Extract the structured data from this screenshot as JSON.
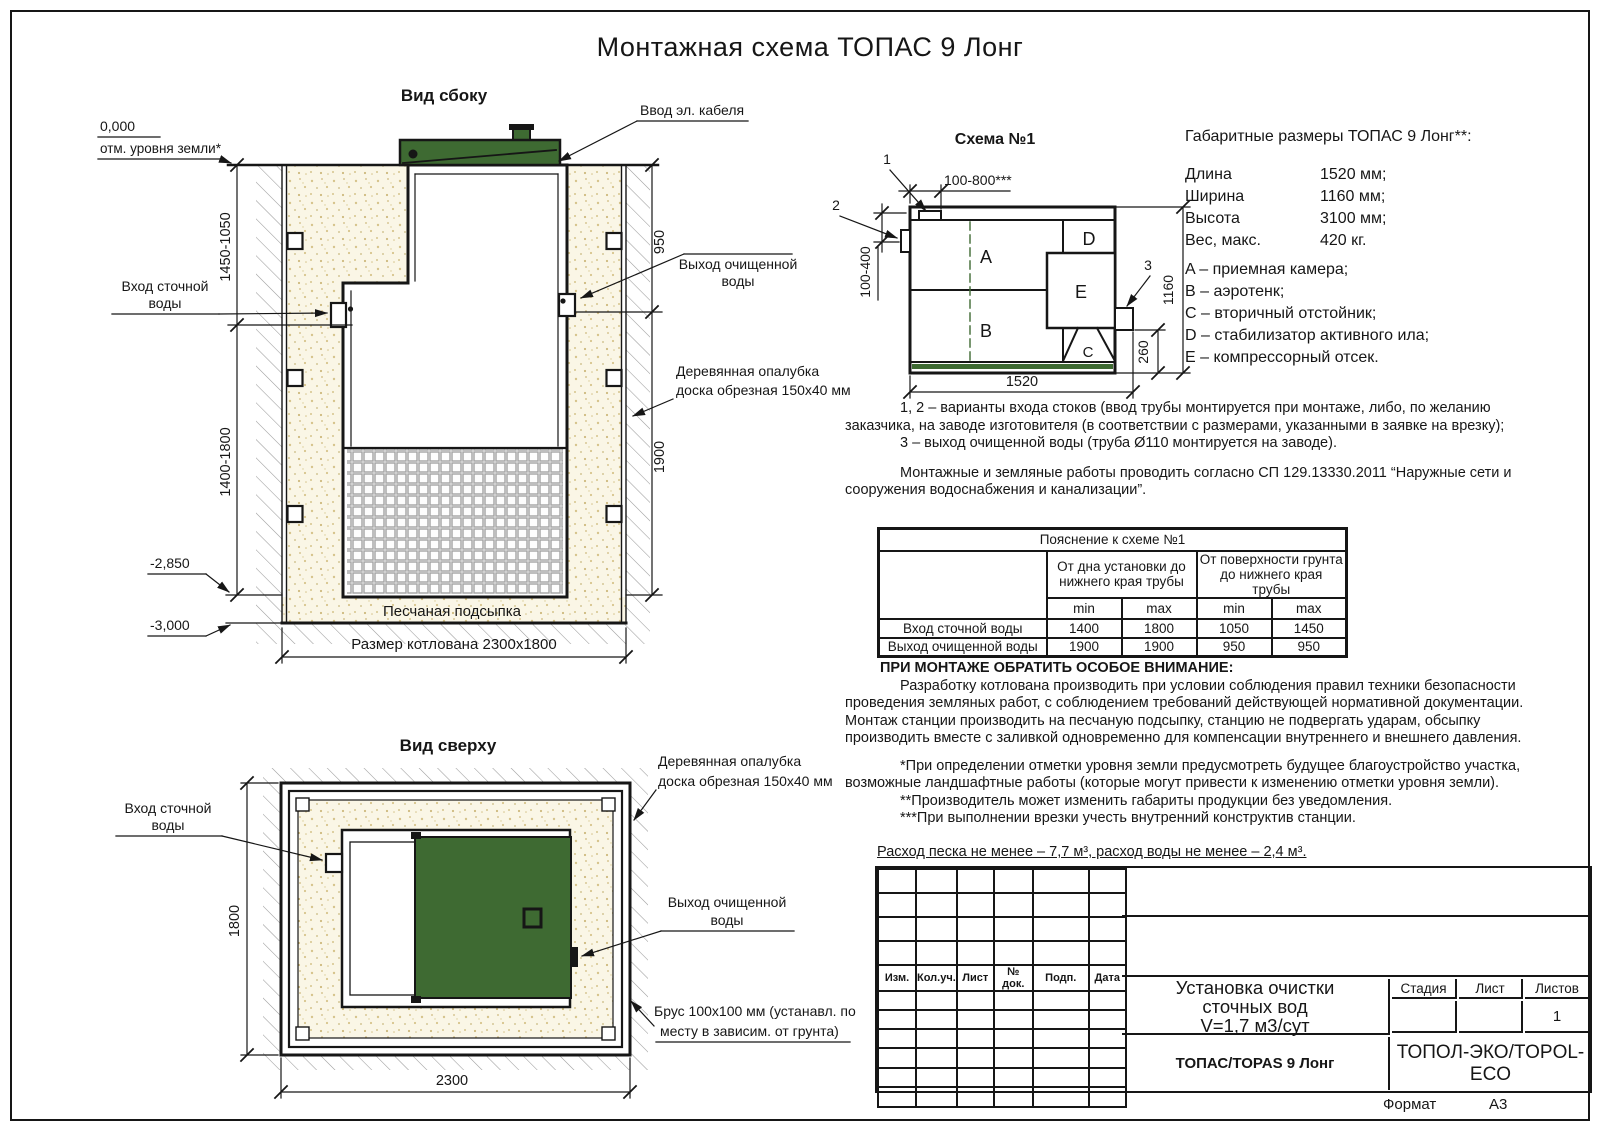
{
  "page": {
    "title": "Монтажная схема ТОПАС 9 Лонг",
    "format_label": "Формат",
    "format_value": "А3"
  },
  "colors": {
    "green": "#3E6A32",
    "line": "#161616",
    "sand_bg": "#faf6e6",
    "sand_dot": "#d6c48c",
    "hatch": "#9a9a9a",
    "grid": "#a3a3a3"
  },
  "side_view": {
    "title": "Вид сбоку",
    "labels": {
      "cable": "Ввод эл. кабеля",
      "zero_mark": "0,000",
      "ground_mark": "отм. уровня земли*",
      "inlet_1": "Вход сточной",
      "inlet_2": "воды",
      "outlet_1": "Выход очищенной",
      "outlet_2": "воды",
      "formwork_1": "Деревянная опалубка",
      "formwork_2": "доска обрезная 150х40 мм",
      "sand": "Песчаная подсыпка",
      "pit_size": "Размер котлована 2300х1800",
      "lvl_sand": "-2,850",
      "lvl_bottom": "-3,000"
    },
    "dims": {
      "left_top": "1450-1050",
      "left_bottom": "1400-1800",
      "right_top": "950",
      "right_bottom": "1900"
    }
  },
  "top_view": {
    "title": "Вид сверху",
    "labels": {
      "inlet_1": "Вход сточной",
      "inlet_2": "воды",
      "formwork_1": "Деревянная опалубка",
      "formwork_2": "доска обрезная 150х40 мм",
      "outlet_1": "Выход очищенной",
      "outlet_2": "воды",
      "beam_1": "Брус 100х100 мм (устанавл. по",
      "beam_2": "месту в зависим. от грунта)"
    },
    "dims": {
      "height": "1800",
      "width": "2300"
    }
  },
  "schema": {
    "title": "Схема №1",
    "callouts": [
      "1",
      "2",
      "3"
    ],
    "letters": [
      "A",
      "B",
      "C",
      "D",
      "E"
    ],
    "dims": {
      "top": "100-800***",
      "left": "100-400",
      "right": "1160",
      "outlet": "260",
      "bottom": "1520"
    }
  },
  "specs": {
    "title": "Габаритные размеры ТОПАС 9 Лонг**:",
    "rows": [
      {
        "label": "Длина",
        "value": "1520 мм;"
      },
      {
        "label": "Ширина",
        "value": "1160 мм;"
      },
      {
        "label": "Высота",
        "value": "3100 мм;"
      },
      {
        "label": "Вес, макс.",
        "value": "420 кг."
      }
    ],
    "legend": [
      "A – приемная камера;",
      "B – аэротенк;",
      "C – вторичный отстойник;",
      "D – стабилизатор активного ила;",
      "E – компрессорный отсек."
    ]
  },
  "notes": {
    "p1": "1, 2 – варианты входа  стоков (ввод трубы монтируется при монтаже, либо, по желанию заказчика, на заводе изготовителя (в соответствии с размерами, указанными в заявке на врезку);",
    "p2": "3 – выход очищенной воды (труба Ø110 монтируется на заводе).",
    "p3": "Монтажные и земляные работы проводить согласно СП 129.13330.2011 “Наружные сети и сооружения водоснабжения и канализации”."
  },
  "table": {
    "title": "Пояснение к схеме №1",
    "group1": "От дна установки до нижнего края трубы",
    "group2": "От поверхности грунта до нижнего края трубы",
    "min": "min",
    "max": "max",
    "rows": [
      {
        "label": "Вход сточной воды",
        "values": [
          "1400",
          "1800",
          "1050",
          "1450"
        ]
      },
      {
        "label": "Выход очищенной воды",
        "values": [
          "1900",
          "1900",
          "950",
          "950"
        ]
      }
    ]
  },
  "attention": {
    "title": "ПРИ МОНТАЖЕ ОБРАТИТЬ ОСОБОЕ ВНИМАНИЕ:",
    "p1": "Разработку котлована производить при условии соблюдения правил техники безопасности проведения земляных работ, с соблюдением требований действующей нормативной документации. Монтаж станции производить на песчаную подсыпку, станцию не подвергать ударам, обсыпку производить вместе с заливкой одновременно для компенсации внутреннего и внешнего давления.",
    "fn1": "*При определении отметки уровня земли предусмотреть будущее благоустройство участка, возможные ландшафтные работы (которые могут привести к изменению отметки уровня земли).",
    "fn2": "**Производитель может изменить габариты продукции без уведомления.",
    "fn3": "***При выполнении врезки учесть внутренний конструктив станции.",
    "consumption": "Расход песка не менее – 7,7 м³, расход воды не менее – 2,4 м³."
  },
  "title_block": {
    "header_cols": [
      "Изм.",
      "Кол.уч.",
      "Лист",
      "№ док.",
      "Подп.",
      "Дата"
    ],
    "doc_title_1": "Установка очистки",
    "doc_title_2": "сточных вод",
    "doc_title_3": "V=1,7 м3/сут",
    "stage": "Стадия",
    "sheet": "Лист",
    "sheets": "Листов",
    "sheets_value": "1",
    "product": "ТОПАС/TOPAS 9 Лонг",
    "company": "ТОПОЛ-ЭКО/TOPOL-ECO"
  }
}
